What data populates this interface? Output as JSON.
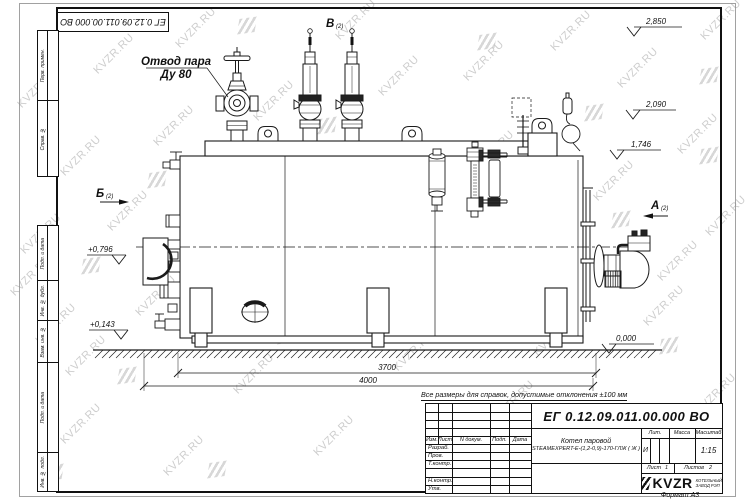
{
  "sheet": {
    "designation": "ЕГ 0.12.09.011.00.000  ВО",
    "note": "Все размеры для справок, допустимые отклонения  ±100 мм",
    "format_label": "Формат А3"
  },
  "watermark": {
    "text": "KVZR.RU"
  },
  "margin_columns": [
    "Перв. примен.",
    "Справ. №",
    "Подп. и дата",
    "Инв. № дубл.",
    "Взам. инв. №",
    "Подп. и дата",
    "Инв. № подл."
  ],
  "title_block": {
    "designation": "ЕГ 0.12.09.011.00.000  ВО",
    "product_name_line1": "Котел паровой",
    "product_name_line2": "STEAMEXPERT-Е-(1,2-0,9)-170-ГЛЖ ( Ж )",
    "headers": {
      "izm": "Изм.",
      "list": "Лист",
      "n_dokum": "N докум.",
      "podp": "Подп.",
      "data": "Дата"
    },
    "rows": [
      "Разраб.",
      "Пров.",
      "Т.контр.",
      "Н.контр.",
      "Утв."
    ],
    "lit_label": "Лит.",
    "lit_value": "И",
    "mass_label": "Масса",
    "scale_label": "Масштаб",
    "scale_value": "1:15",
    "sheet_label": "Лист",
    "sheet_value": "1",
    "sheets_label": "Листов",
    "sheets_value": "2",
    "logo_text": "KVZR",
    "logo_sub1": "КОТЕЛЬНЫЙ",
    "logo_sub2": "ЗАВОД РЭП"
  },
  "annotations": {
    "steam_outlet_line1": "Отвод пара",
    "steam_outlet_line2": "Ду 80",
    "view_a": "А",
    "view_b": "Б",
    "view_v": "В",
    "view_ref": "(2)"
  },
  "elevations": {
    "e2850": "2,850",
    "e2090": "2,090",
    "e1746": "1,746",
    "e0": "0,000",
    "e0796": "+0,796",
    "e0143": "+0,143"
  },
  "dimensions": {
    "d3700": "3700",
    "d4000": "4000"
  }
}
